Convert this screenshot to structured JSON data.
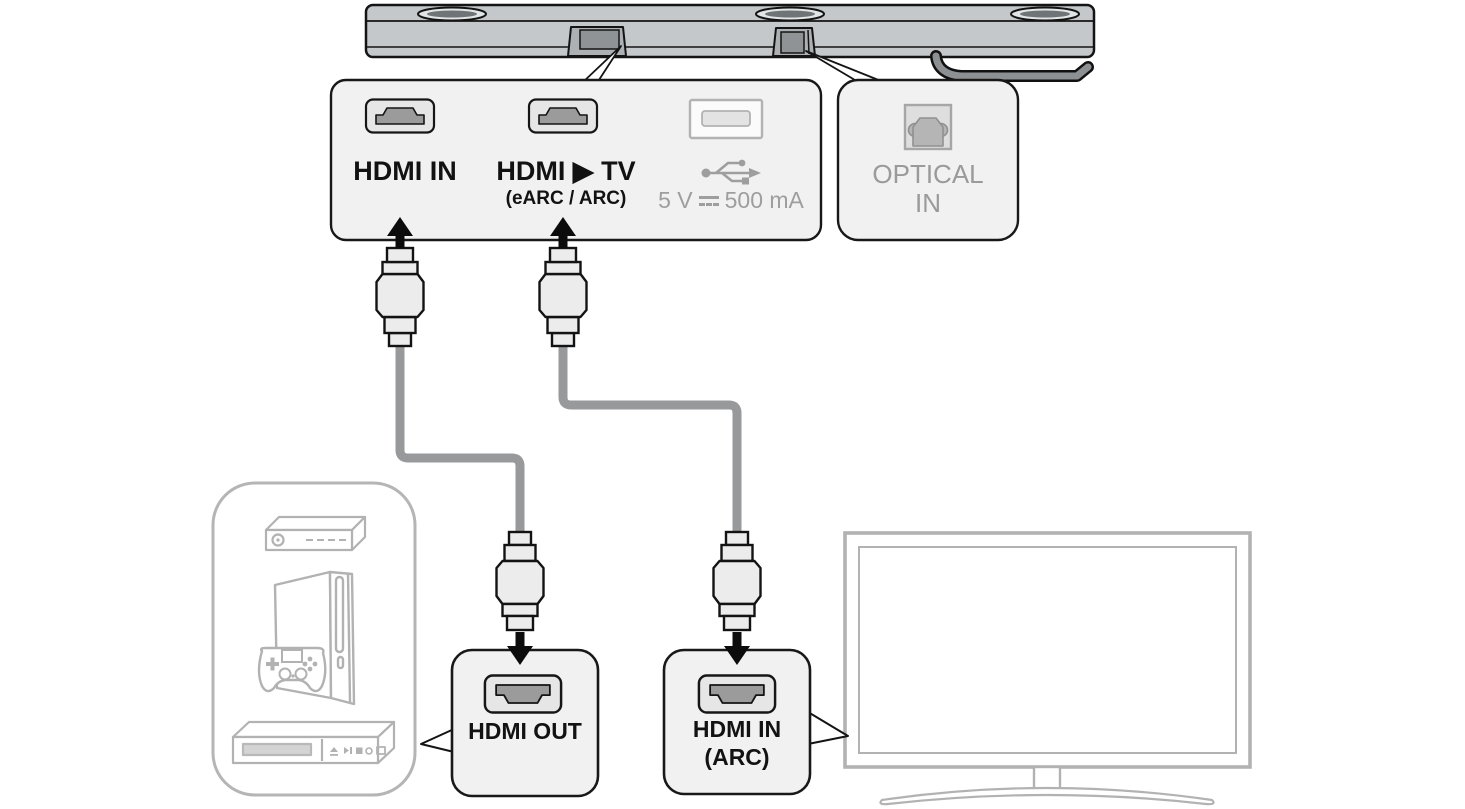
{
  "diagram": {
    "kind": "soundbar-connection-diagram",
    "soundbar_rear_panel": {
      "hdmi_in_port_label": "HDMI IN",
      "hdmi_tv_port_label": "HDMI ▶ TV",
      "hdmi_tv_port_sublabel": "(eARC / ARC)",
      "usb_power_volt": "5 V",
      "usb_power_current": "500 mA"
    },
    "optical_panel": {
      "label_line1": "OPTICAL",
      "label_line2": "IN"
    },
    "external_device_ports": {
      "hdmi_out_label": "HDMI OUT",
      "hdmi_in_arc_label_line1": "HDMI IN",
      "hdmi_in_arc_label_line2": "(ARC)"
    },
    "icons": [
      "hdmi-port-icon",
      "usb-port-icon",
      "optical-port-icon",
      "usb-trident-icon",
      "dc-power-icon",
      "up-arrow-icon",
      "down-arrow-icon",
      "set-top-box-icon",
      "game-console-icon",
      "gamepad-icon",
      "disc-player-icon",
      "tv-icon",
      "soundbar-icon",
      "hdmi-plug-icon",
      "power-cable-icon"
    ],
    "colors": {
      "background": "#ffffff",
      "outline_dark": "#171717",
      "panel_fill": "#f1f1f1",
      "soundbar_fill": "#c5c8ca",
      "soundbar_recess": "#a9adb0",
      "hdmi_inner": "#9b9b9b",
      "cable_gray": "#97999b",
      "plug_fill": "#ececec",
      "muted_text": "#9a9a9a",
      "muted_line": "#b2b2b2",
      "arrow_black": "#0c0c0c"
    }
  }
}
